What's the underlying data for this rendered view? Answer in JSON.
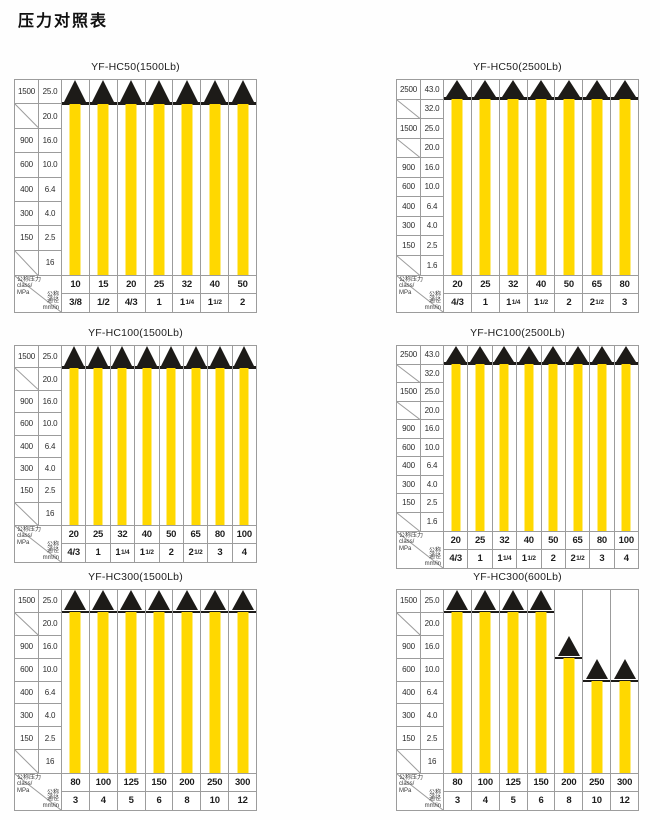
{
  "page_title": "压力对照表",
  "axis_header": {
    "pressure_lines": [
      "公称压力",
      "class/",
      "MPa"
    ],
    "size_lines": [
      "公称",
      "通径",
      "mm/in"
    ]
  },
  "colors": {
    "bar": "#FFD800",
    "triangle": "#1D1B18",
    "grid": "#9C9C9C",
    "text": "#2B2B2B"
  },
  "chart_data": [
    {
      "type": "bar",
      "title": "YF-HC50(1500Lb)",
      "y_rows": [
        {
          "class": "1500",
          "mpa": "25.0"
        },
        {
          "class": null,
          "mpa": "20.0"
        },
        {
          "class": "900",
          "mpa": "16.0"
        },
        {
          "class": "600",
          "mpa": "10.0"
        },
        {
          "class": "400",
          "mpa": "6.4"
        },
        {
          "class": "300",
          "mpa": "4.0"
        },
        {
          "class": "150",
          "mpa": "2.5"
        },
        {
          "class": null,
          "mpa": "16"
        }
      ],
      "columns": [
        {
          "class": "10",
          "size": "3/8",
          "size_frac": null,
          "bar_top_row": 0
        },
        {
          "class": "15",
          "size": "1/2",
          "size_frac": null,
          "bar_top_row": 0
        },
        {
          "class": "20",
          "size": "4/3",
          "size_frac": null,
          "bar_top_row": 0
        },
        {
          "class": "25",
          "size": "1",
          "size_frac": null,
          "bar_top_row": 0
        },
        {
          "class": "32",
          "size": "1",
          "size_frac": "1/4",
          "bar_top_row": 0
        },
        {
          "class": "40",
          "size": "1",
          "size_frac": "1/2",
          "bar_top_row": 0
        },
        {
          "class": "50",
          "size": "2",
          "size_frac": null,
          "bar_top_row": 0
        }
      ]
    },
    {
      "type": "bar",
      "title": "YF-HC50(2500Lb)",
      "y_rows": [
        {
          "class": "2500",
          "mpa": "43.0"
        },
        {
          "class": null,
          "mpa": "32.0"
        },
        {
          "class": "1500",
          "mpa": "25.0"
        },
        {
          "class": null,
          "mpa": "20.0"
        },
        {
          "class": "900",
          "mpa": "16.0"
        },
        {
          "class": "600",
          "mpa": "10.0"
        },
        {
          "class": "400",
          "mpa": "6.4"
        },
        {
          "class": "300",
          "mpa": "4.0"
        },
        {
          "class": "150",
          "mpa": "2.5"
        },
        {
          "class": null,
          "mpa": "1.6"
        }
      ],
      "columns": [
        {
          "class": "20",
          "size": "4/3",
          "size_frac": null,
          "bar_top_row": 0
        },
        {
          "class": "25",
          "size": "1",
          "size_frac": null,
          "bar_top_row": 0
        },
        {
          "class": "32",
          "size": "1",
          "size_frac": "1/4",
          "bar_top_row": 0
        },
        {
          "class": "40",
          "size": "1",
          "size_frac": "1/2",
          "bar_top_row": 0
        },
        {
          "class": "50",
          "size": "2",
          "size_frac": null,
          "bar_top_row": 0
        },
        {
          "class": "65",
          "size": "2",
          "size_frac": "1/2",
          "bar_top_row": 0
        },
        {
          "class": "80",
          "size": "3",
          "size_frac": null,
          "bar_top_row": 0
        }
      ]
    },
    {
      "type": "bar",
      "title": "YF-HC100(1500Lb)",
      "y_rows": [
        {
          "class": "1500",
          "mpa": "25.0"
        },
        {
          "class": null,
          "mpa": "20.0"
        },
        {
          "class": "900",
          "mpa": "16.0"
        },
        {
          "class": "600",
          "mpa": "10.0"
        },
        {
          "class": "400",
          "mpa": "6.4"
        },
        {
          "class": "300",
          "mpa": "4.0"
        },
        {
          "class": "150",
          "mpa": "2.5"
        },
        {
          "class": null,
          "mpa": "16"
        }
      ],
      "columns": [
        {
          "class": "20",
          "size": "4/3",
          "size_frac": null,
          "bar_top_row": 0
        },
        {
          "class": "25",
          "size": "1",
          "size_frac": null,
          "bar_top_row": 0
        },
        {
          "class": "32",
          "size": "1",
          "size_frac": "1/4",
          "bar_top_row": 0
        },
        {
          "class": "40",
          "size": "1",
          "size_frac": "1/2",
          "bar_top_row": 0
        },
        {
          "class": "50",
          "size": "2",
          "size_frac": null,
          "bar_top_row": 0
        },
        {
          "class": "65",
          "size": "2",
          "size_frac": "1/2",
          "bar_top_row": 0
        },
        {
          "class": "80",
          "size": "3",
          "size_frac": null,
          "bar_top_row": 0
        },
        {
          "class": "100",
          "size": "4",
          "size_frac": null,
          "bar_top_row": 0
        }
      ]
    },
    {
      "type": "bar",
      "title": "YF-HC100(2500Lb)",
      "y_rows": [
        {
          "class": "2500",
          "mpa": "43.0"
        },
        {
          "class": null,
          "mpa": "32.0"
        },
        {
          "class": "1500",
          "mpa": "25.0"
        },
        {
          "class": null,
          "mpa": "20.0"
        },
        {
          "class": "900",
          "mpa": "16.0"
        },
        {
          "class": "600",
          "mpa": "10.0"
        },
        {
          "class": "400",
          "mpa": "6.4"
        },
        {
          "class": "300",
          "mpa": "4.0"
        },
        {
          "class": "150",
          "mpa": "2.5"
        },
        {
          "class": null,
          "mpa": "1.6"
        }
      ],
      "columns": [
        {
          "class": "20",
          "size": "4/3",
          "size_frac": null,
          "bar_top_row": 0
        },
        {
          "class": "25",
          "size": "1",
          "size_frac": null,
          "bar_top_row": 0
        },
        {
          "class": "32",
          "size": "1",
          "size_frac": "1/4",
          "bar_top_row": 0
        },
        {
          "class": "40",
          "size": "1",
          "size_frac": "1/2",
          "bar_top_row": 0
        },
        {
          "class": "50",
          "size": "2",
          "size_frac": null,
          "bar_top_row": 0
        },
        {
          "class": "65",
          "size": "2",
          "size_frac": "1/2",
          "bar_top_row": 0
        },
        {
          "class": "80",
          "size": "3",
          "size_frac": null,
          "bar_top_row": 0
        },
        {
          "class": "100",
          "size": "4",
          "size_frac": null,
          "bar_top_row": 0
        }
      ]
    },
    {
      "type": "bar",
      "title": "YF-HC300(1500Lb)",
      "y_rows": [
        {
          "class": "1500",
          "mpa": "25.0"
        },
        {
          "class": null,
          "mpa": "20.0"
        },
        {
          "class": "900",
          "mpa": "16.0"
        },
        {
          "class": "600",
          "mpa": "10.0"
        },
        {
          "class": "400",
          "mpa": "6.4"
        },
        {
          "class": "300",
          "mpa": "4.0"
        },
        {
          "class": "150",
          "mpa": "2.5"
        },
        {
          "class": null,
          "mpa": "16"
        }
      ],
      "columns": [
        {
          "class": "80",
          "size": "3",
          "size_frac": null,
          "bar_top_row": 0
        },
        {
          "class": "100",
          "size": "4",
          "size_frac": null,
          "bar_top_row": 0
        },
        {
          "class": "125",
          "size": "5",
          "size_frac": null,
          "bar_top_row": 0
        },
        {
          "class": "150",
          "size": "6",
          "size_frac": null,
          "bar_top_row": 0
        },
        {
          "class": "200",
          "size": "8",
          "size_frac": null,
          "bar_top_row": 0
        },
        {
          "class": "250",
          "size": "10",
          "size_frac": null,
          "bar_top_row": 0
        },
        {
          "class": "300",
          "size": "12",
          "size_frac": null,
          "bar_top_row": 0
        }
      ]
    },
    {
      "type": "bar",
      "title": "YF-HC300(600Lb)",
      "y_rows": [
        {
          "class": "1500",
          "mpa": "25.0"
        },
        {
          "class": null,
          "mpa": "20.0"
        },
        {
          "class": "900",
          "mpa": "16.0"
        },
        {
          "class": "600",
          "mpa": "10.0"
        },
        {
          "class": "400",
          "mpa": "6.4"
        },
        {
          "class": "300",
          "mpa": "4.0"
        },
        {
          "class": "150",
          "mpa": "2.5"
        },
        {
          "class": null,
          "mpa": "16"
        }
      ],
      "columns": [
        {
          "class": "80",
          "size": "3",
          "size_frac": null,
          "bar_top_row": 0
        },
        {
          "class": "100",
          "size": "4",
          "size_frac": null,
          "bar_top_row": 0
        },
        {
          "class": "125",
          "size": "5",
          "size_frac": null,
          "bar_top_row": 0
        },
        {
          "class": "150",
          "size": "6",
          "size_frac": null,
          "bar_top_row": 0
        },
        {
          "class": "200",
          "size": "8",
          "size_frac": null,
          "bar_top_row": 2
        },
        {
          "class": "250",
          "size": "10",
          "size_frac": null,
          "bar_top_row": 3
        },
        {
          "class": "300",
          "size": "12",
          "size_frac": null,
          "bar_top_row": 3
        }
      ]
    }
  ]
}
